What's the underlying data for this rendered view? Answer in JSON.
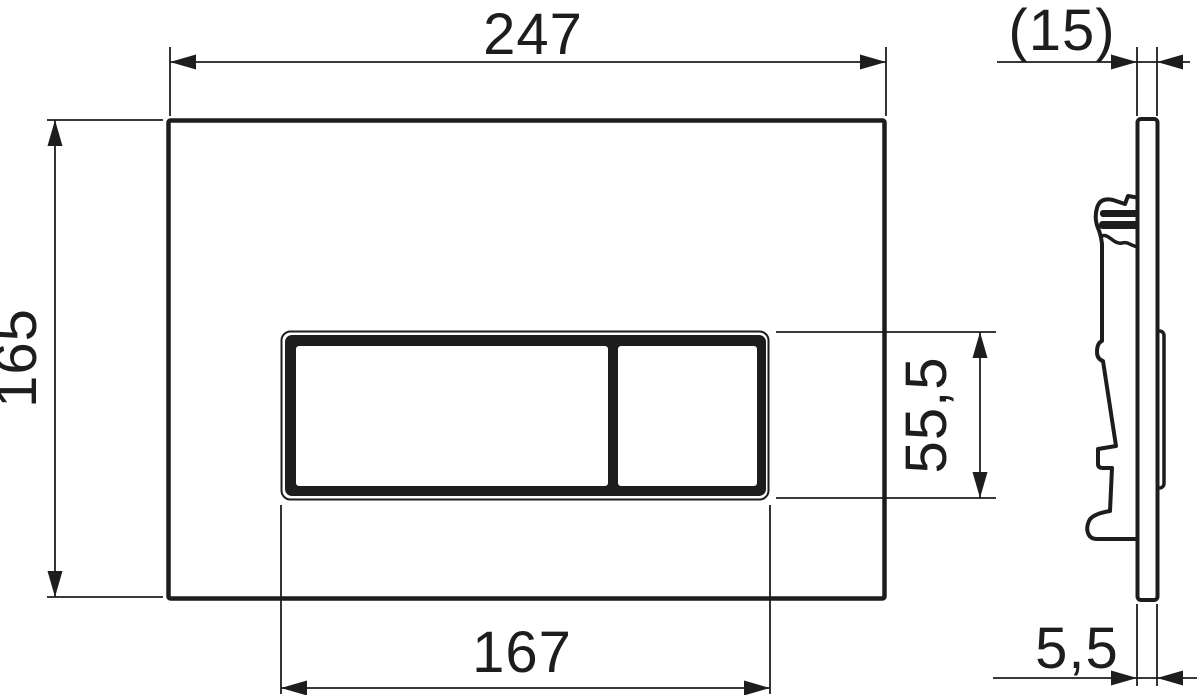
{
  "title": "Flush plate technical drawing",
  "colors": {
    "line": "#1d1d1d",
    "background": "#ffffff"
  },
  "front_view": {
    "overall_width": "247",
    "overall_height": "165",
    "button_panel_width": "167",
    "button_panel_height": "55,5"
  },
  "side_view": {
    "overall_depth": "(15)",
    "plate_thickness": "5,5"
  }
}
